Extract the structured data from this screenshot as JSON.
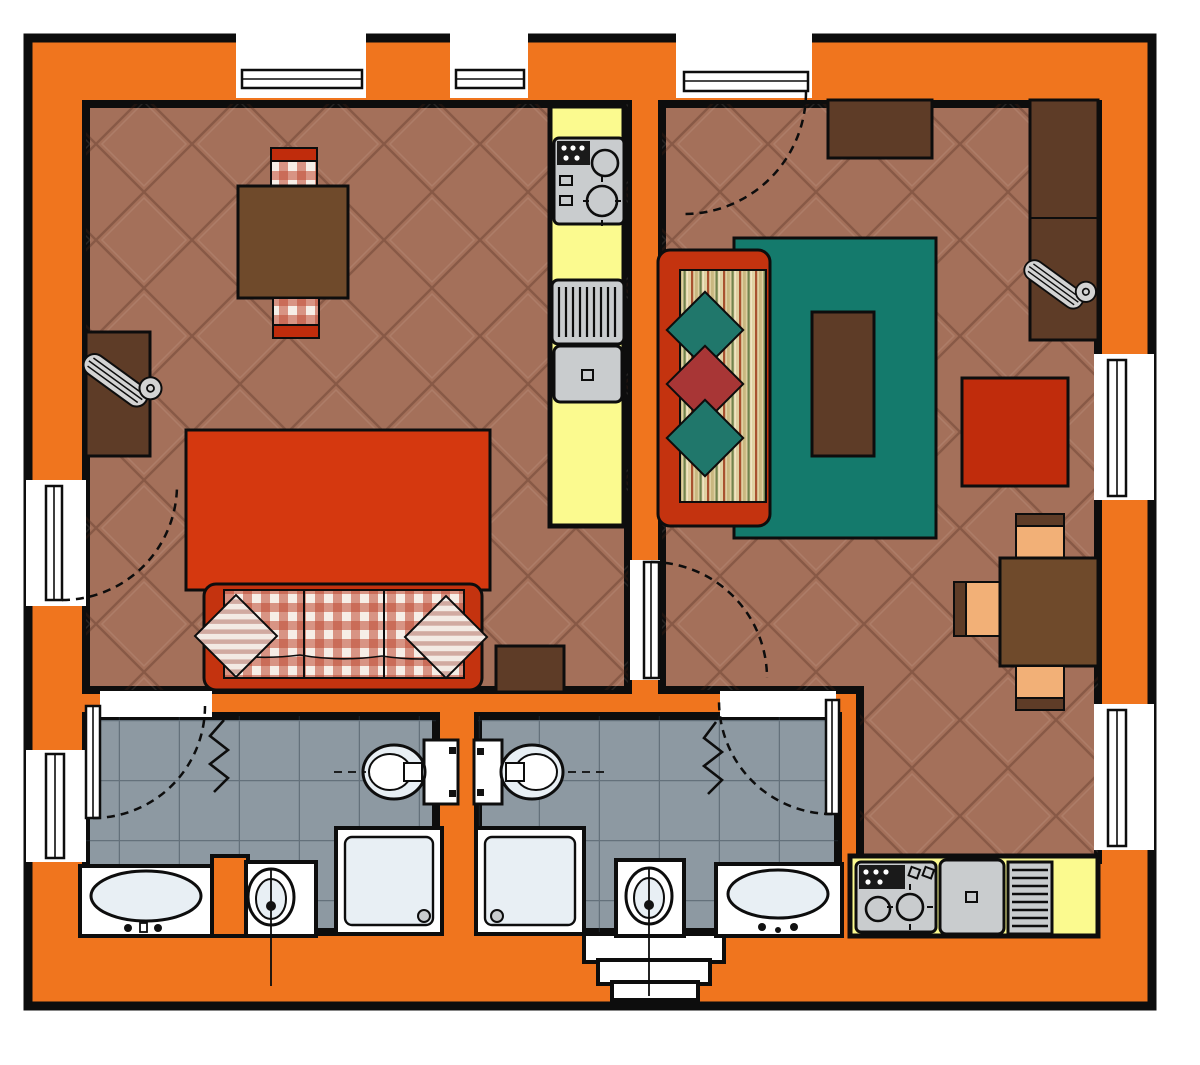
{
  "plan": {
    "kind": "apartment-floor-plan",
    "rooms": {
      "living_kitchen": {
        "name": "living-kitchen",
        "items": [
          "dining-table",
          "checkered-chair",
          "checkered-chair",
          "kitchen-counter",
          "cooktop",
          "sink-with-drainer",
          "tv-cabinet",
          "tv",
          "red-rug",
          "sofa-checkered",
          "striped-pillow",
          "striped-pillow",
          "side-table",
          "entry-door-left",
          "windows-top"
        ]
      },
      "living_room_2": {
        "name": "living-room",
        "items": [
          "entry-door-top",
          "wall-cabinet",
          "wardrobe-sideboard",
          "tv",
          "striped-sofa",
          "diamond-pillow",
          "diamond-pillow",
          "diamond-pillow",
          "teal-rug",
          "coffee-table",
          "red-armchair-table",
          "dining-table",
          "peach-chair",
          "peach-chair",
          "peach-chair",
          "kitchenette-counter",
          "cooktop",
          "sink-with-drainer",
          "windows-right"
        ]
      },
      "bathroom_1": {
        "name": "bathroom-1",
        "items": [
          "door",
          "radiator",
          "toilet",
          "bidet",
          "shower-tray",
          "bathtub",
          "window-left"
        ]
      },
      "bathroom_2": {
        "name": "bathroom-2",
        "items": [
          "door",
          "radiator",
          "toilet",
          "bidet",
          "shower-tray",
          "bathtub",
          "window-bay-bottom"
        ]
      }
    }
  },
  "colors": {
    "wall": "#F0751E",
    "outline": "#0D0D0D",
    "floor": "#A4705A",
    "bath_tile": "#8D99A2",
    "kitchen": "#FBFA8F",
    "rug_teal": "#147A6C",
    "rug_red": "#D5380F",
    "sofa_red": "#C4330F",
    "accent_red": "#C02C0C",
    "wood_dark": "#5E3C27",
    "wood_mid": "#6F4A2B",
    "chair_peach": "#F2B077",
    "fixture": "#FFFFFF",
    "fixture_shade": "#E8EFF4",
    "appliance": "#C9CCCE",
    "tv_gray": "#D3D3D3",
    "gingham": "#BE4B32",
    "pillow_stripe": "#C89A90",
    "diamond_teal": "#20776B",
    "diamond_red": "#A83636",
    "sofa_fabric_base": "#DFD0A2",
    "sofa_fabric_stripe_red": "#A8512F",
    "sofa_fabric_stripe_tan": "#C9B780",
    "sofa_fabric_stripe_green": "#72834E"
  }
}
